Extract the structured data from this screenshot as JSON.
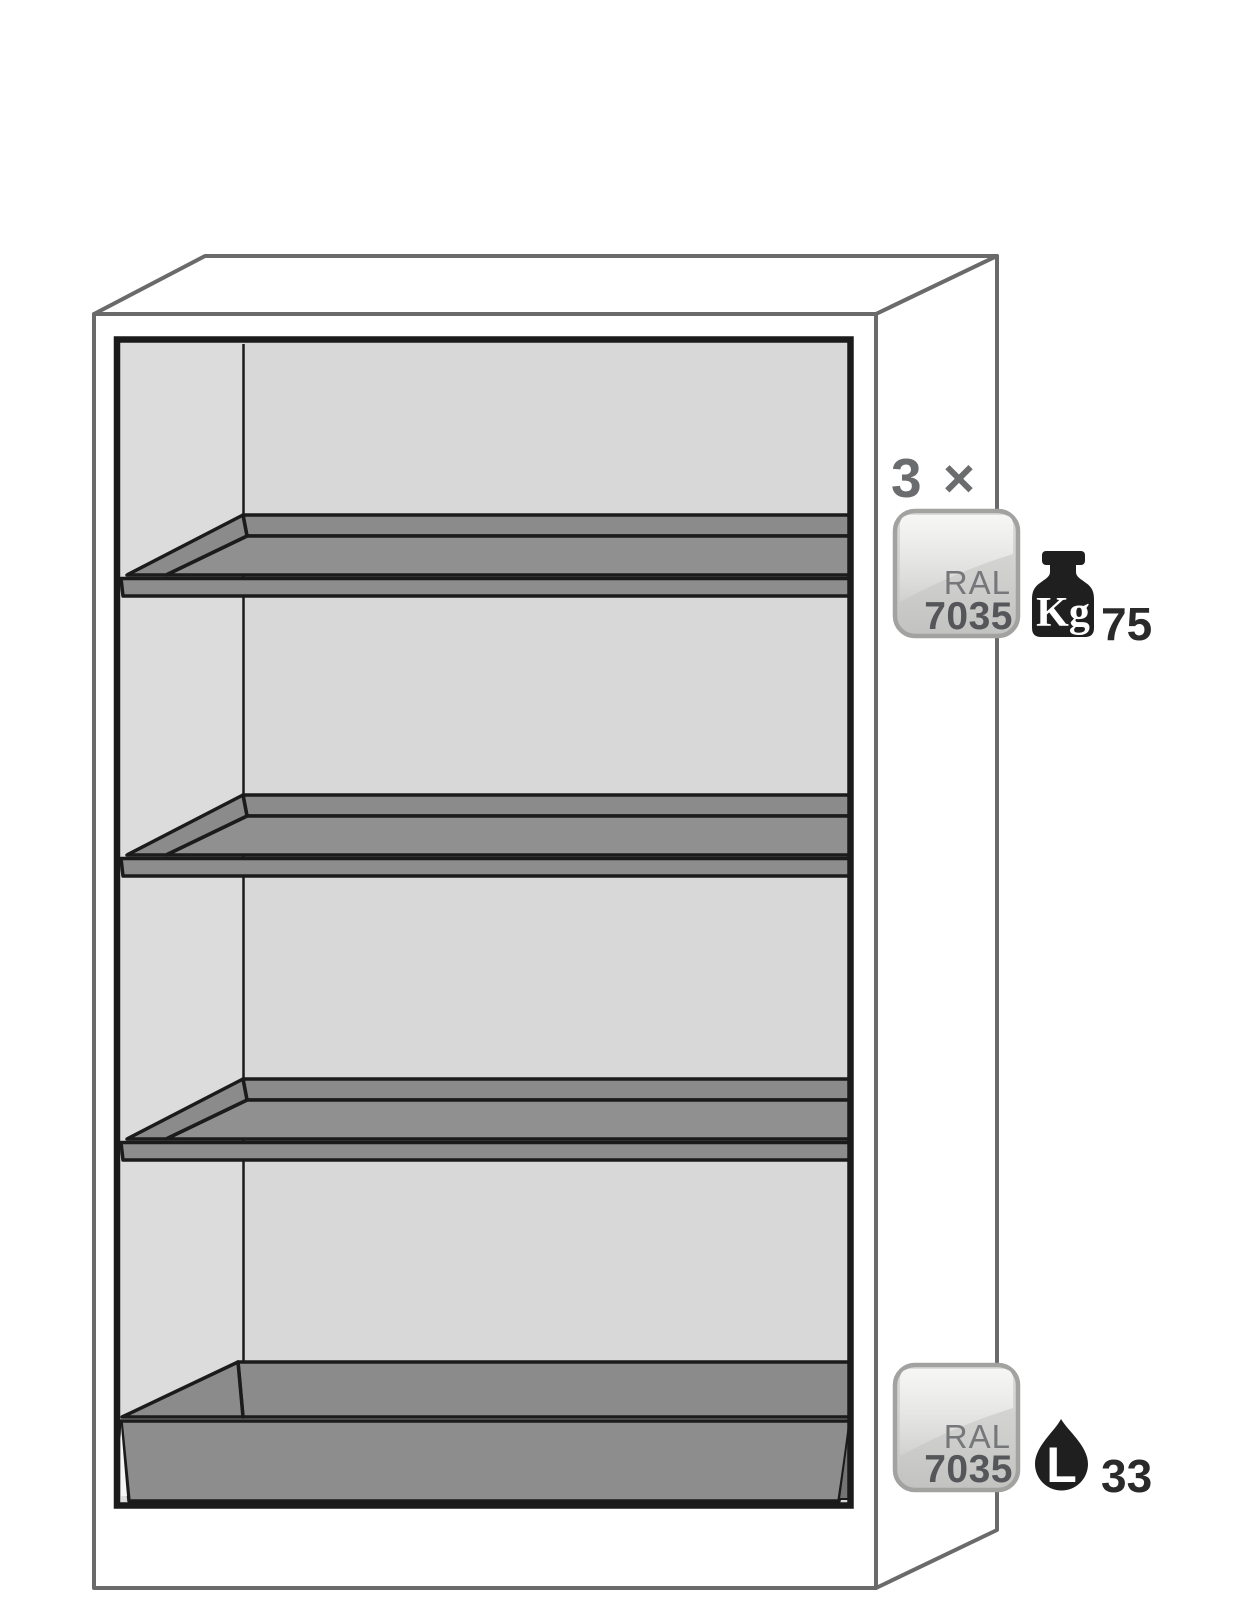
{
  "diagram": {
    "title": "safety-cabinet-interior-equipment-diagram",
    "shelf_count_label": "3 ×",
    "top_badge": {
      "line1": "RAL",
      "line2": "7035"
    },
    "load_capacity": {
      "unit": "Kg",
      "value": "75"
    },
    "bottom_badge": {
      "line1": "RAL",
      "line2": "7035"
    },
    "sump_volume": {
      "unit": "L",
      "value": "33"
    },
    "icons": {
      "weight": "weight-kg-icon",
      "drop": "liquid-drop-icon"
    },
    "colors": {
      "outline_gray": "#6a6a6a",
      "ink_black": "#1b1b1b",
      "back_wall": "#d8d8d8",
      "left_wall": "#dcdcdc",
      "shelf_gray": "#8b8b8b",
      "shelf_floor_gray": "#909090",
      "shelf_front_gray": "#8d8d8d",
      "sump_wedge_gray": "#747474",
      "badge_border": "#a2a2a0",
      "badge_text_light": "#76777a",
      "badge_text_dark": "#55565a",
      "annotation_gray": "#6b6c6e",
      "value_ink": "#2a2a2b"
    }
  }
}
